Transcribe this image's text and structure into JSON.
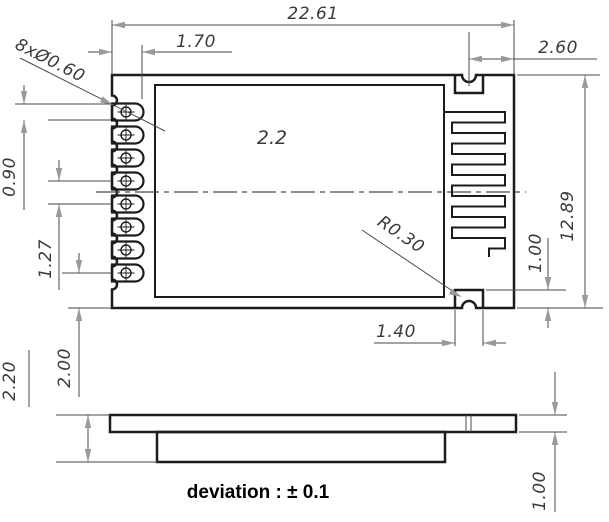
{
  "drawing": {
    "type": "mechanical-dimension-drawing",
    "views": [
      "top-view",
      "side-view"
    ],
    "colors": {
      "outline": "#1c1c1c",
      "dimension_line": "#4a4a4a",
      "arrowhead": "#9a9a9a",
      "dimension_text": "#3a3a3a",
      "note_text": "#000000",
      "background": "#ffffff"
    },
    "dims": {
      "overall_width": "22.61",
      "pin_pad_length": "1.70",
      "antenna_hole_offset": "2.60",
      "pin_holes_callout": "8xØ0.60",
      "pin_pad_width": "0.90",
      "pin_pitch": "1.27",
      "last_pin_to_edge": "2.00",
      "overall_height": "12.89",
      "center_label": "2.2",
      "half_hole_radius": "R0.30",
      "half_hole_pad_width": "1.40",
      "half_hole_pad_depth": "1.00",
      "stack_thickness": "2.20",
      "pcb_thickness": "1.00",
      "tolerance_note": "deviation : ± 0.1"
    },
    "features": {
      "pin_count": 8,
      "antenna": "meander-pcb-antenna",
      "edge_half_holes": 2
    }
  }
}
